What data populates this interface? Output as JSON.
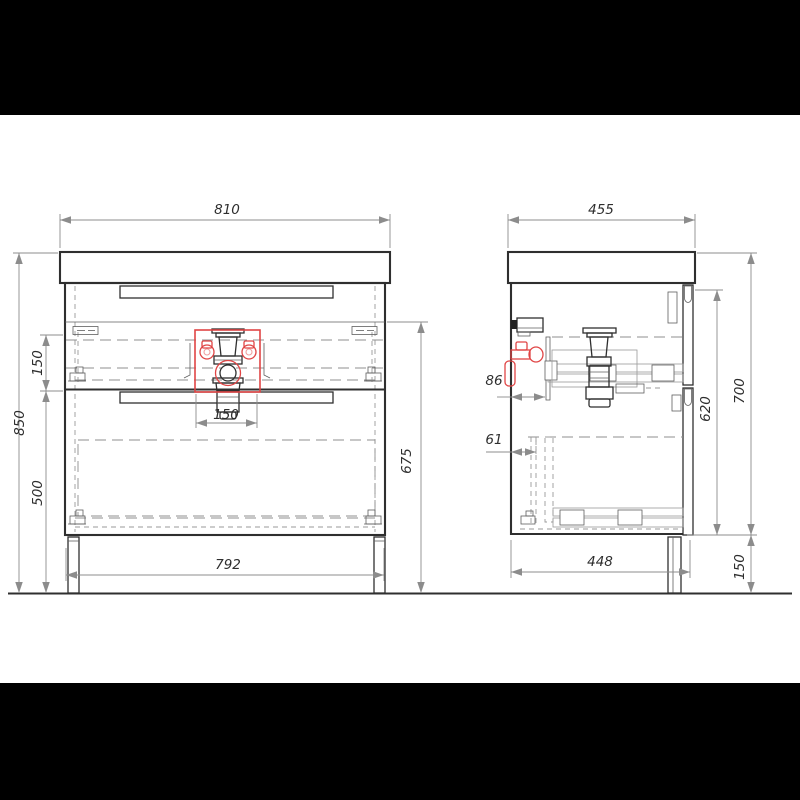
{
  "drawing": {
    "type": "vanity-cabinet-technical-drawing",
    "views": {
      "front": "front elevation",
      "side": "side section"
    },
    "colors": {
      "highlight_red": "#e04545",
      "line_dark": "#2f2f2f",
      "dim_gray": "#8c8c8c",
      "letterbox": "#000000",
      "paper": "#ffffff"
    },
    "dims": {
      "front": {
        "top_width": "810",
        "overall_height": "850",
        "top_drawer_height": "150",
        "bottom_drawer_height": "500",
        "body_height": "675",
        "drain_cutout_width": "150",
        "bottom_width": "792"
      },
      "side": {
        "top_depth": "455",
        "drain_back_offset": "86",
        "drawer_back_offset": "61",
        "inner_height": "620",
        "body_height": "700",
        "leg_height": "150",
        "bottom_depth": "448"
      }
    }
  }
}
